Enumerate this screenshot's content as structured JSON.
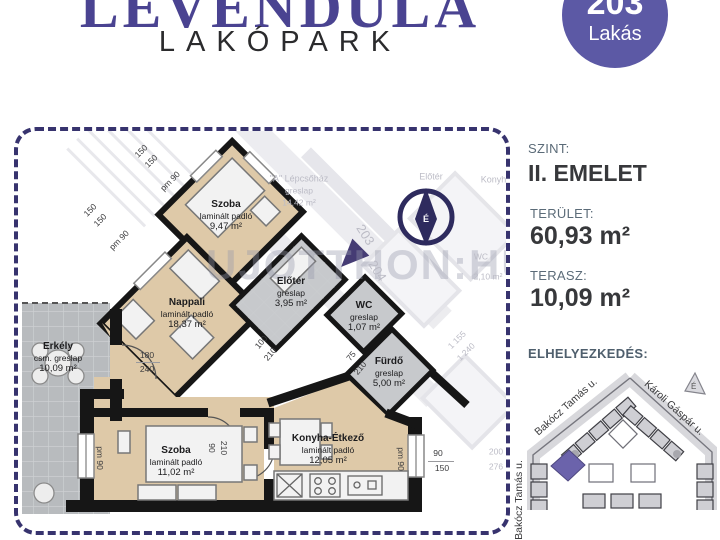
{
  "header": {
    "title": "LEVENDULA",
    "subtitle": "LAKÓPARK",
    "badge_number": "203",
    "badge_label": "Lakás"
  },
  "watermark": "UJOTTHON:HU",
  "floorplan": {
    "rooms": [
      {
        "name": "Szoba",
        "floor": "laminált padló",
        "area": "9,47 m²"
      },
      {
        "name": "Nappali",
        "floor": "laminált padló",
        "area": "18,37 m²"
      },
      {
        "name": "Előtér",
        "floor": "greslap",
        "area": "3,95 m²"
      },
      {
        "name": "WC",
        "floor": "greslap",
        "area": "1,07 m²"
      },
      {
        "name": "Fürdő",
        "floor": "greslap",
        "area": "5,00 m²"
      },
      {
        "name": "Szoba",
        "floor": "laminált padló",
        "area": "11,02 m²"
      },
      {
        "name": "Konyha-Étkező",
        "floor": "laminált padló",
        "area": "12,05 m²"
      },
      {
        "name": "Erkély",
        "floor": "csm. greslap",
        "area": "10,09 m²"
      }
    ],
    "dims": [
      "150",
      "150",
      "pm 90",
      "150",
      "150",
      "pm 90",
      "180",
      "240",
      "100",
      "210",
      "75",
      "210",
      "90",
      "210",
      "pm 90",
      "pm 90",
      "90",
      "150"
    ],
    "compass_letter": "É"
  },
  "background": {
    "labels": [
      "\"A\" Lépcsőház",
      "greslap",
      "14,42 m²",
      "Előtér",
      "Konyha",
      "203",
      "204",
      "WC",
      "2,10 m²",
      "1 155",
      "1 240",
      "200",
      "276"
    ]
  },
  "details": {
    "floor_label": "SZINT:",
    "floor_value": "II. EMELET",
    "area_label": "TERÜLET:",
    "area_value": "60,93 m²",
    "terrace_label": "TERASZ:",
    "terrace_value": "10,09 m²",
    "location_label": "ELHELYEZKEDÉS:"
  },
  "map": {
    "street_left_diagonal": "Bakócz Tamás u.",
    "street_right_diagonal": "Károli Gáspár u.",
    "street_left_vertical": "Bakócz Tamás u.",
    "compass_letter": "É"
  },
  "colors": {
    "title_purple": "#4a4391",
    "badge_purple": "#5c59a5",
    "dashed_border_navy": "#37336e",
    "laminate_beige": "#dec9a8",
    "tile_gray": "#c7c9cc",
    "wall_black": "#161616",
    "map_unit_purple": "#6b63ab",
    "detail_label_gray": "#5b6b78",
    "detail_value_dark": "#37383b"
  }
}
